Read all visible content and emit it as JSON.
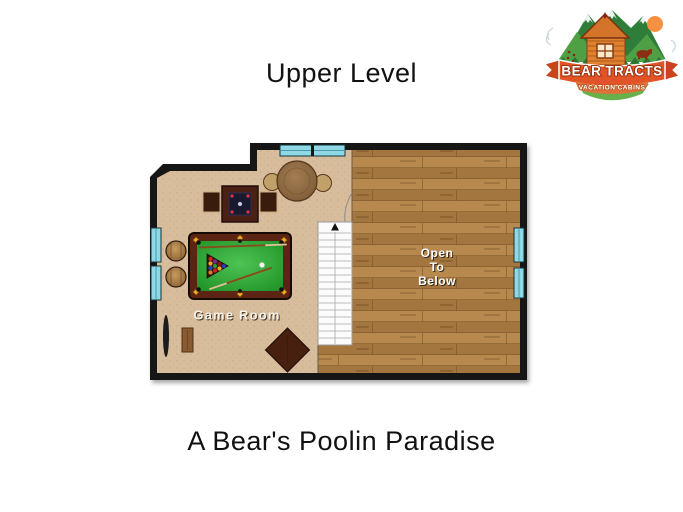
{
  "page": {
    "title": "Upper Level",
    "caption": "A Bear's Poolin Paradise"
  },
  "logo": {
    "brand": "BEAR TRACTS",
    "tagline": "VACATION CABINS",
    "colors": {
      "ribbon": "#e25427",
      "mountain_dark": "#2e7d3a",
      "mountain_light": "#4f9f45",
      "shield_green": "#66b14a",
      "cabin_orange": "#e0812f",
      "sun_orange": "#f59140"
    }
  },
  "plan": {
    "game_room_label": "Game Room",
    "open_line1": "Open",
    "open_line2": "To",
    "open_line3": "Below",
    "stairs": {
      "direction": "up",
      "steps": 17
    },
    "windows": {
      "top": 1,
      "left": 2,
      "right": 2
    },
    "furniture": [
      "pool-table",
      "game-table",
      "round-table",
      "barrel-stools",
      "ottoman",
      "side-table"
    ],
    "colors": {
      "carpet": "#d8bd9d",
      "wood": "#b08046",
      "wall": "#161616",
      "window": "#8fd9e6",
      "pool_felt_light": "#4ec455",
      "pool_felt_dark": "#1d8f23",
      "pool_rail": "#5c2412",
      "stair_fill": "#fbfbfb"
    }
  }
}
